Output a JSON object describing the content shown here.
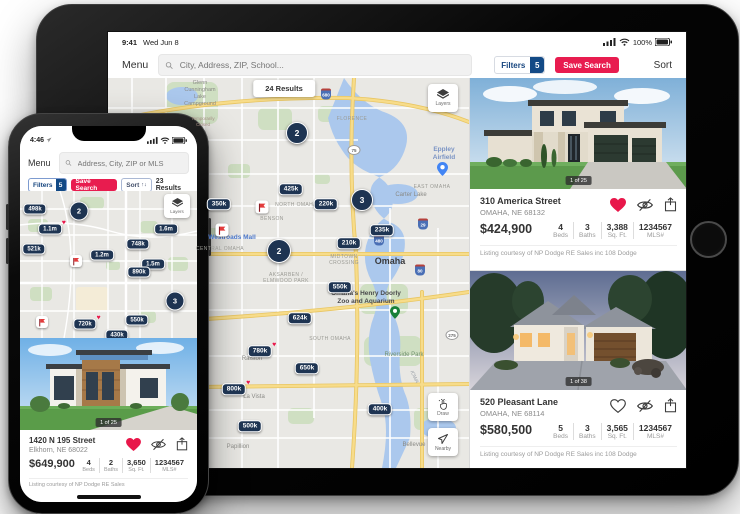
{
  "theme": {
    "accent_red": "#e81c4f",
    "accent_blue": "#134a86",
    "pin_navy": "#1e3452"
  },
  "ipad": {
    "status": {
      "time": "9:41",
      "date": "Wed Jun 8",
      "battery": "100%"
    },
    "header": {
      "menu": "Menu",
      "search_placeholder": "City, Address, ZIP, School...",
      "filters_label": "Filters",
      "filters_count": "5",
      "save_search": "Save Search",
      "sort": "Sort"
    },
    "map": {
      "results": "24 Results",
      "layers": "Layers",
      "draw": "Draw",
      "nearby": "Nearby",
      "places": [
        {
          "text": "Glenn\nCunningham\nLake\nCampground"
        },
        {
          "text": "Temporarily\nClosed"
        },
        {
          "text": "FLORENCE"
        },
        {
          "text": "EAST OMAHA"
        },
        {
          "text": "Eppley\nAirfield"
        },
        {
          "text": "Carter Lake"
        },
        {
          "text": "NORTH OMAHA"
        },
        {
          "text": "BENSON"
        },
        {
          "text": "Westroads Mall"
        },
        {
          "text": "CENTRAL OMAHA"
        },
        {
          "text": "MIDTOWN\nCROSSING"
        },
        {
          "text": "Omaha"
        },
        {
          "text": "AKSARBEN /\nELMWOOD PARK"
        },
        {
          "text": "Omaha's Henry Doorly\nZoo and Aquarium"
        },
        {
          "text": "SOUTH OMAHA"
        },
        {
          "text": "Riverside Park"
        },
        {
          "text": "Ralston"
        },
        {
          "text": "IOWA"
        },
        {
          "text": "La Vista"
        },
        {
          "text": "Papillion"
        },
        {
          "text": "Bellevue"
        }
      ],
      "pins": [
        {
          "label": "425k",
          "fav": false
        },
        {
          "label": "350k",
          "fav": false
        },
        {
          "label": "220k",
          "fav": false
        },
        {
          "label": "235k",
          "fav": false
        },
        {
          "label": "210k",
          "fav": false
        },
        {
          "label": "550k",
          "fav": false
        },
        {
          "label": "624k",
          "fav": false
        },
        {
          "label": "780k",
          "fav": true
        },
        {
          "label": "650k",
          "fav": false
        },
        {
          "label": "800k",
          "fav": true
        },
        {
          "label": "400k",
          "fav": false
        },
        {
          "label": "500k",
          "fav": false
        }
      ],
      "clusters": [
        {
          "n": "2"
        },
        {
          "n": "3"
        },
        {
          "n": "2"
        }
      ],
      "shields": [
        {
          "n": "680"
        },
        {
          "n": "75"
        },
        {
          "n": "480"
        },
        {
          "n": "29"
        },
        {
          "n": "80"
        },
        {
          "n": "275"
        }
      ]
    },
    "listings": [
      {
        "badge": "1 of 25",
        "address": "310 America Street",
        "city": "OMAHA, NE 68132",
        "price": "$424,900",
        "favorited": true,
        "stats": [
          {
            "v": "4",
            "l": "Beds"
          },
          {
            "v": "3",
            "l": "Baths"
          },
          {
            "v": "3,388",
            "l": "Sq. Ft."
          },
          {
            "v": "1234567",
            "l": "MLS#"
          }
        ],
        "courtesy": "Listing courtesy of NP Dodge RE Sales inc 108 Dodge"
      },
      {
        "badge": "1 of 38",
        "address": "520 Pleasant Lane",
        "city": "OMAHA, NE 68114",
        "price": "$580,500",
        "favorited": false,
        "stats": [
          {
            "v": "5",
            "l": "Beds"
          },
          {
            "v": "3",
            "l": "Baths"
          },
          {
            "v": "3,565",
            "l": "Sq. Ft."
          },
          {
            "v": "1234567",
            "l": "MLS#"
          }
        ],
        "courtesy": "Listing courtesy of NP Dodge RE Sales inc 108 Dodge"
      }
    ]
  },
  "iphone": {
    "status": {
      "time": "4:46"
    },
    "header": {
      "menu": "Menu",
      "search_placeholder": "Address, City, ZIP or MLS"
    },
    "toolbar": {
      "filters_label": "Filters",
      "filters_count": "5",
      "save_search": "Save Search",
      "sort": "Sort",
      "results": "23 Results"
    },
    "map": {
      "layers": "Layers",
      "pins": [
        {
          "label": "498k",
          "fav": false
        },
        {
          "label": "1.1m",
          "fav": true
        },
        {
          "label": "521k",
          "fav": false
        },
        {
          "label": "1.2m",
          "fav": false
        },
        {
          "label": "748k",
          "fav": false
        },
        {
          "label": "1.6m",
          "fav": false
        },
        {
          "label": "1.5m",
          "fav": false
        },
        {
          "label": "890k",
          "fav": false
        },
        {
          "label": "720k",
          "fav": true
        },
        {
          "label": "550k",
          "fav": false
        },
        {
          "label": "430k",
          "fav": false
        }
      ],
      "clusters": [
        {
          "n": "2"
        },
        {
          "n": "3"
        }
      ]
    },
    "listing": {
      "badge": "1 of 25",
      "address": "1420 N 195 Street",
      "city": "Elkhorn, NE 68022",
      "price": "$649,900",
      "favorited": true,
      "stats": [
        {
          "v": "4",
          "l": "Beds"
        },
        {
          "v": "2",
          "l": "Baths"
        },
        {
          "v": "3,650",
          "l": "Sq. Ft."
        },
        {
          "v": "1234567",
          "l": "MLS#"
        }
      ],
      "courtesy": "Listing courtesy of NP Dodge RE Sales"
    }
  }
}
